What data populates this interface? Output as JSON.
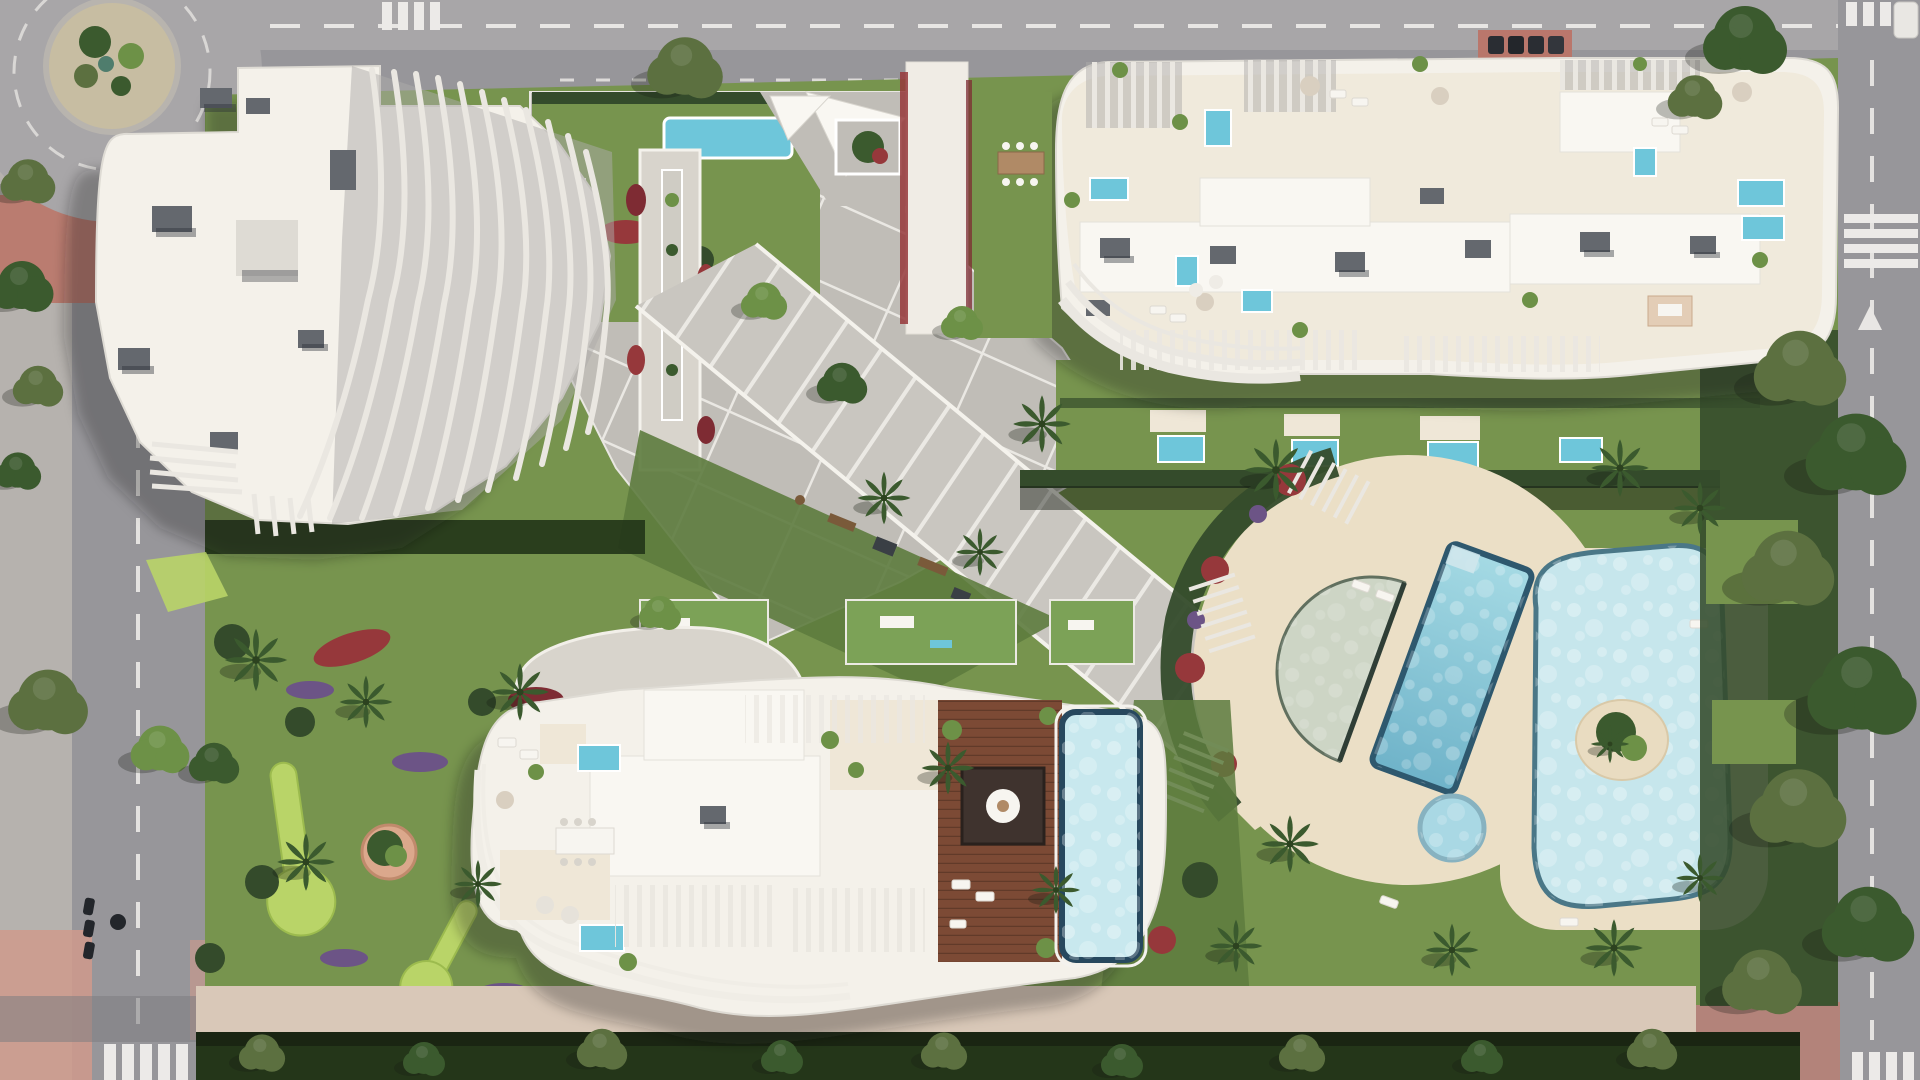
{
  "meta": {
    "title": "Aerial render of a residential resort complex",
    "view": "top-down architectural visualization, no on-screen text",
    "width": 1920,
    "height": 1080
  },
  "palette": {
    "asphalt": "#97969a",
    "asphaltLight": "#a8a6a8",
    "asphaltDark": "#7e7d81",
    "sidewalk": "#b6b2ae",
    "marking": "#eceae8",
    "redPave": "#bb7265",
    "redPaveLight": "#cf9a8c",
    "island": "#c7bda2",
    "lawn": "#77944e",
    "lawnDark": "#5d7b3e",
    "lawnBright": "#b9d468",
    "hedge": "#344b2b",
    "hedgeDark": "#243619",
    "flowerRed": "#96383b",
    "flowerPurple": "#6c5486",
    "flowerCrimson": "#7e2b33",
    "plaza": "#c0bdb7",
    "prom": "#c9c6c0",
    "path": "#d8d4cc",
    "deckC": "#ebdfc6",
    "pinkWalk": "#d9c8b8",
    "bottomRoad": "#b3837a",
    "roof": "#f4f1ea",
    "roofBright": "#f9f7f2",
    "roofShade": "#dedbd4",
    "terrace": "#efe7d7",
    "louver": "#eae7e1",
    "louverBase": "#aeacaa",
    "roofBox": "#64686e",
    "roofBoxDark": "#4a4e54",
    "wood": "#7c4a35",
    "woodDark": "#5f3828",
    "pool": "#6ec6da",
    "poolLight": "#c6e6ec",
    "lap": "#8fccd9",
    "shallow": "#cdd5c5",
    "rim": "#2e586e",
    "spaC": "#a9d8e4",
    "sand": "#e9dcc1",
    "tree": "#3b5a2e",
    "treeLight": "#6d9147",
    "olive": "#5c7040",
    "shadowC": "rgba(25,28,38,0.30)"
  },
  "labels": {
    "scene": "Aerial view of residential complex with three white buildings, gardens and pools",
    "roads": "Perimeter streets with lane markings and zebra crossings",
    "roundabout": "Roundabout with planted center island, top-left",
    "building_nw": "North-west tower with sculptural curved louvered balconies",
    "building_ne": "North-east building with rooftop terraces and plunge pools",
    "building_s": "South building with timber roof deck and infinity pool",
    "plaza": "Central paved plaza with white grid joints",
    "promenade": "Diagonal pedestrian promenade",
    "pool_area": "Communal pool deck: lap pool, half-moon kids pool, lagoon pool with island, spa",
    "gardens": "Landscaped gardens with lawns, putting greens, palms and flower beds",
    "gym": "Outdoor gym lawn",
    "bottom_walk": "Southern boundary walk and hedge"
  },
  "scene": {
    "buildings": [
      {
        "id": "north-west",
        "roof": "white flat roof, grey plant boxes, fanned louver balconies east side"
      },
      {
        "id": "north-east",
        "roof": "cream terraces, 7 small plunge pools, pergola slats, lounge furniture"
      },
      {
        "id": "south",
        "roof": "left white terraces with 2 plunge pools, right mahogany deck, dark pavilion, large infinity pool"
      }
    ],
    "amenities": [
      "lap pool",
      "semicircular beach-entry pool",
      "free-form lagoon pool with palm island",
      "round spa",
      "outdoor gym",
      "2 lime putting greens",
      "pergola walk",
      "sun sails"
    ],
    "roads": {
      "top": "horizontal avenue",
      "left": "vertical street from roundabout",
      "right": "vertical avenue",
      "bottom": "reddish service road",
      "crossings": 6
    },
    "vegetation": [
      "street trees",
      "palm clusters",
      "dense boundary hedges",
      "red and purple flower carpets"
    ]
  }
}
